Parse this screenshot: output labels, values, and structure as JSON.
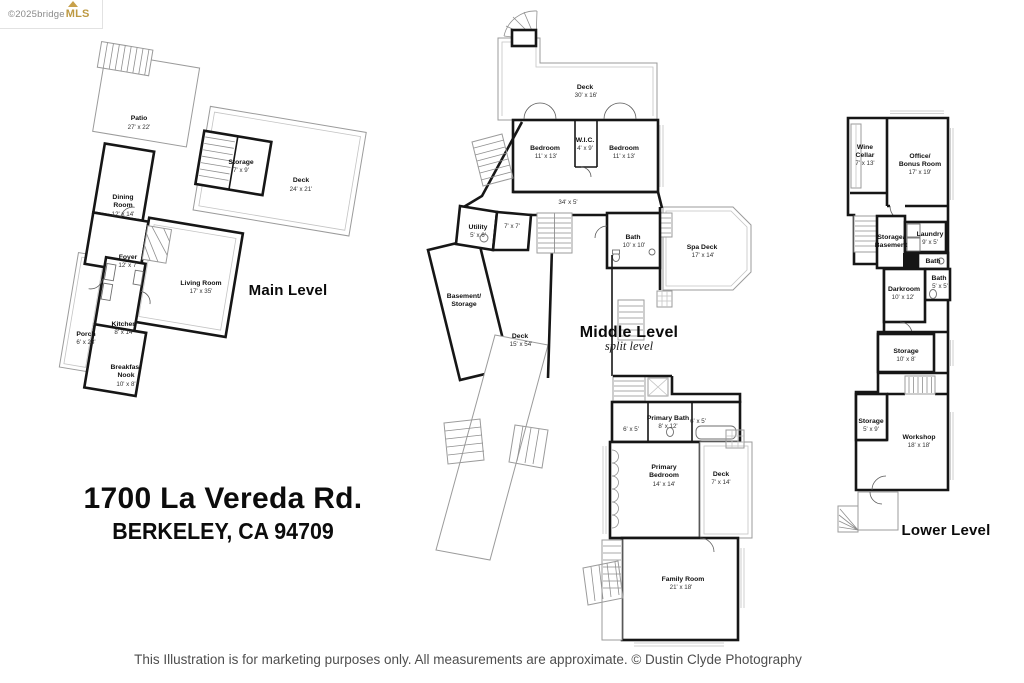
{
  "watermark": {
    "copyright": "©2025 ",
    "brand_gray": "bridge",
    "brand_gold": "MLS"
  },
  "address": {
    "line1": "1700 La Vereda Rd.",
    "line2": "BERKELEY, CA  94709"
  },
  "footer": {
    "disclaimer": "This Illustration is for marketing purposes only.  All measurements are approximate.  © Dustin Clyde Photography"
  },
  "levels": {
    "main": {
      "title": "Main Level",
      "rooms": {
        "patio": {
          "n": "Patio",
          "d": "27' x 22'"
        },
        "storage": {
          "n": "Storage",
          "d": "7' x 9'"
        },
        "deck": {
          "n": "Deck",
          "d": "24' x 21'"
        },
        "dining": {
          "n": "Dining",
          "n2": "Room",
          "d": "12' x 14'"
        },
        "foyer": {
          "n": "Foyer",
          "d": "12' x 7'"
        },
        "living": {
          "n": "Living Room",
          "d": "17' x 35'"
        },
        "porch": {
          "n": "Porch",
          "d": "6' x 23'"
        },
        "kitchen": {
          "n": "Kitchen",
          "d": "8' x 14'"
        },
        "breakfast": {
          "n": "Breakfast",
          "n2": "Nook",
          "d": "10' x 8'"
        }
      }
    },
    "middle": {
      "title": "Middle Level",
      "subtitle": "split level",
      "rooms": {
        "deck30": {
          "n": "Deck",
          "d": "30' x 16'"
        },
        "bedroom1": {
          "n": "Bedroom",
          "d": "11' x 13'"
        },
        "wic": {
          "n": "W.I.C.",
          "d": "4' x 9'"
        },
        "bedroom2": {
          "n": "Bedroom",
          "d": "11' x 13'"
        },
        "hall": {
          "d": "34' x 5'"
        },
        "utility": {
          "n": "Utility",
          "d": "5' x 6'"
        },
        "room7": {
          "d": "7' x 7'"
        },
        "bath": {
          "n": "Bath",
          "d": "10' x 10'"
        },
        "spadeck": {
          "n": "Spa Deck",
          "d": "17' x 14'"
        },
        "basement": {
          "n": "Basement/",
          "n2": "Storage"
        },
        "deck54": {
          "n": "Deck",
          "d": "15' x 54'"
        },
        "primarybath": {
          "n": "Primary Bath",
          "d": "8' x 12'"
        },
        "closet1": {
          "d": "6' x 5'"
        },
        "closet2": {
          "d": "6' x 5'"
        },
        "primarybedroom": {
          "n": "Primary",
          "n2": "Bedroom",
          "d": "14' x 14'"
        },
        "deck7": {
          "n": "Deck",
          "d": "7' x 14'"
        },
        "family": {
          "n": "Family Room",
          "d": "21' x 18'"
        }
      }
    },
    "lower": {
      "title": "Lower Level",
      "rooms": {
        "wine": {
          "n": "Wine",
          "n2": "Cellar",
          "d": "7' x 13'"
        },
        "office": {
          "n": "Office/",
          "n2": "Bonus Room",
          "d": "17' x 19'"
        },
        "storagebasement": {
          "n": "Storage/",
          "n2": "Basement"
        },
        "laundry": {
          "n": "Laundry",
          "d": "9' x 5'"
        },
        "bath1": {
          "n": "Bath"
        },
        "bath2": {
          "n": "Bath",
          "d": "5' x 5'"
        },
        "darkroom": {
          "n": "Darkroom",
          "d": "10' x 12'"
        },
        "storage10": {
          "n": "Storage",
          "d": "10' x 8'"
        },
        "storage5": {
          "n": "Storage",
          "d": "5' x 9'"
        },
        "workshop": {
          "n": "Workshop",
          "d": "18' x 18'"
        }
      }
    }
  }
}
